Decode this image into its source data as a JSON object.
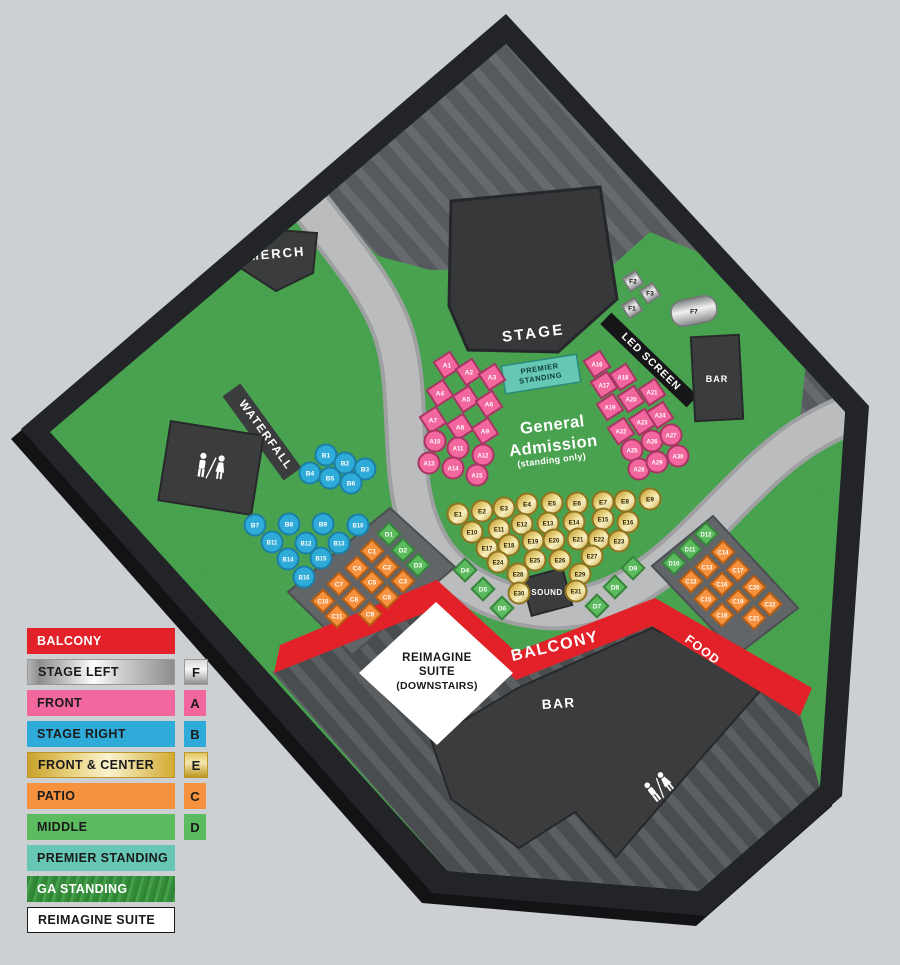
{
  "legend": {
    "items": [
      {
        "label": "BALCONY",
        "badge": "",
        "style": "solid",
        "color": "#E32128",
        "text_color": "#ffffff"
      },
      {
        "label": "STAGE LEFT",
        "badge": "F",
        "style": "silver",
        "color": "",
        "text_color": "#1a1a1a"
      },
      {
        "label": "FRONT",
        "badge": "A",
        "style": "solid",
        "color": "#F2679E",
        "text_color": "#1a1a1a"
      },
      {
        "label": "STAGE RIGHT",
        "badge": "B",
        "style": "solid",
        "color": "#2FABD9",
        "text_color": "#1a1a1a"
      },
      {
        "label": "FRONT & CENTER",
        "badge": "E",
        "style": "gold",
        "color": "",
        "text_color": "#1a1a1a"
      },
      {
        "label": "PATIO",
        "badge": "C",
        "style": "solid",
        "color": "#F6913E",
        "text_color": "#1a1a1a"
      },
      {
        "label": "MIDDLE",
        "badge": "D",
        "style": "solid",
        "color": "#5CBB5E",
        "text_color": "#1a1a1a"
      },
      {
        "label": "PREMIER STANDING",
        "badge": "",
        "style": "solid",
        "color": "#66C7B4",
        "text_color": "#1a1a1a"
      },
      {
        "label": "GA STANDING",
        "badge": "",
        "style": "grass",
        "color": "",
        "text_color": "#ffffff"
      },
      {
        "label": "REIMAGINE SUITE",
        "badge": "",
        "style": "white",
        "color": "#ffffff",
        "text_color": "#1a1a1a"
      }
    ]
  },
  "map": {
    "labels": {
      "merch": "MERCH",
      "waterfall": "WATERFALL",
      "stage": "STAGE",
      "led": "LED SCREEN",
      "bar_top": "BAR",
      "bar_bottom": "BAR",
      "sound": "SOUND",
      "balcony": "BALCONY",
      "food": "FOOD",
      "premier": [
        "PREMIER",
        "STANDING"
      ],
      "ga": [
        "General",
        "Admission",
        "(standing only)"
      ],
      "reimagine": [
        "REIMAGINE",
        "SUITE",
        "(DOWNSTAIRS)"
      ]
    },
    "sections": {
      "A": {
        "name": "FRONT",
        "fill": "#F2679E",
        "stroke": "#A83563",
        "text": "#ffffff"
      },
      "B": {
        "name": "STAGE RIGHT",
        "fill": "#2FABD9",
        "stroke": "#1B7FA6",
        "text": "#ffffff"
      },
      "C": {
        "name": "PATIO",
        "fill": "#F6913E",
        "stroke": "#B65E14",
        "text": "#ffffff"
      },
      "D": {
        "name": "MIDDLE",
        "fill": "#5CBB5E",
        "stroke": "#37853B",
        "text": "#ffffff"
      },
      "E": {
        "name": "FRONT & CENTER",
        "fill": "gold",
        "stroke": "#8F7420",
        "text": "#2e2605"
      },
      "F": {
        "name": "STAGE LEFT",
        "fill": "silver",
        "stroke": "#767676",
        "text": "#141414"
      }
    },
    "tables": {
      "A": [
        [
          "A1",
          447,
          365,
          "q"
        ],
        [
          "A2",
          469,
          372,
          "q"
        ],
        [
          "A3",
          492,
          377,
          "q"
        ],
        [
          "A4",
          440,
          393,
          "q"
        ],
        [
          "A5",
          466,
          399,
          "q"
        ],
        [
          "A6",
          489,
          404,
          "q"
        ],
        [
          "A7",
          433,
          420,
          "q"
        ],
        [
          "A8",
          460,
          427,
          "q"
        ],
        [
          "A9",
          485,
          431,
          "q"
        ],
        [
          "A10",
          435,
          441,
          "c"
        ],
        [
          "A11",
          458,
          448,
          "c"
        ],
        [
          "A12",
          483,
          455,
          "c"
        ],
        [
          "A13",
          429,
          463,
          "c"
        ],
        [
          "A14",
          453,
          468,
          "c"
        ],
        [
          "A15",
          477,
          475,
          "c"
        ],
        [
          "A16",
          597,
          364,
          "q"
        ],
        [
          "A17",
          604,
          385,
          "q"
        ],
        [
          "A18",
          623,
          377,
          "q"
        ],
        [
          "A19",
          610,
          407,
          "q"
        ],
        [
          "A20",
          631,
          399,
          "q"
        ],
        [
          "A21",
          652,
          392,
          "q"
        ],
        [
          "A22",
          621,
          431,
          "q"
        ],
        [
          "A23",
          642,
          422,
          "q"
        ],
        [
          "A24",
          660,
          415,
          "q"
        ],
        [
          "A25",
          632,
          450,
          "c"
        ],
        [
          "A26",
          652,
          441,
          "c"
        ],
        [
          "A27",
          671,
          435,
          "c"
        ],
        [
          "A28",
          639,
          469,
          "c"
        ],
        [
          "A29",
          657,
          462,
          "c"
        ],
        [
          "A30",
          678,
          456,
          "c"
        ]
      ],
      "B": [
        [
          "B1",
          326,
          455,
          "c"
        ],
        [
          "B2",
          345,
          463,
          "c"
        ],
        [
          "B3",
          365,
          469,
          "c"
        ],
        [
          "B4",
          310,
          473,
          "c"
        ],
        [
          "B5",
          330,
          478,
          "c"
        ],
        [
          "B6",
          351,
          483,
          "c"
        ],
        [
          "B7",
          255,
          525,
          "c"
        ],
        [
          "B8",
          289,
          524,
          "c"
        ],
        [
          "B9",
          323,
          524,
          "c"
        ],
        [
          "B10",
          358,
          525,
          "c"
        ],
        [
          "B11",
          272,
          542,
          "c"
        ],
        [
          "B12",
          306,
          543,
          "c"
        ],
        [
          "B13",
          339,
          543,
          "c"
        ],
        [
          "B14",
          288,
          559,
          "c"
        ],
        [
          "B15",
          321,
          558,
          "c"
        ],
        [
          "B16",
          304,
          577,
          "c"
        ]
      ],
      "C": [
        [
          "C1",
          372,
          551,
          "d"
        ],
        [
          "C2",
          387,
          567,
          "d"
        ],
        [
          "C3",
          403,
          581,
          "d"
        ],
        [
          "C4",
          357,
          568,
          "d"
        ],
        [
          "C5",
          372,
          582,
          "d"
        ],
        [
          "C6",
          387,
          597,
          "d"
        ],
        [
          "C7",
          339,
          584,
          "d"
        ],
        [
          "C8",
          354,
          599,
          "d"
        ],
        [
          "C9",
          370,
          614,
          "d"
        ],
        [
          "C10",
          323,
          601,
          "d"
        ],
        [
          "C11",
          337,
          616,
          "d"
        ],
        [
          "C12",
          691,
          581,
          "d"
        ],
        [
          "C13",
          707,
          567,
          "d"
        ],
        [
          "C14",
          723,
          552,
          "d"
        ],
        [
          "C15",
          706,
          599,
          "d"
        ],
        [
          "C16",
          722,
          584,
          "d"
        ],
        [
          "C17",
          738,
          570,
          "d"
        ],
        [
          "C18",
          722,
          615,
          "d"
        ],
        [
          "C19",
          738,
          601,
          "d"
        ],
        [
          "C20",
          754,
          587,
          "d"
        ],
        [
          "C21",
          754,
          618,
          "d"
        ],
        [
          "C22",
          770,
          604,
          "d"
        ]
      ],
      "D": [
        [
          "D1",
          389,
          534,
          "d"
        ],
        [
          "D2",
          403,
          550,
          "d"
        ],
        [
          "D3",
          418,
          565,
          "d"
        ],
        [
          "D4",
          465,
          570,
          "d"
        ],
        [
          "D5",
          483,
          589,
          "d"
        ],
        [
          "D6",
          502,
          608,
          "d"
        ],
        [
          "D7",
          597,
          606,
          "d"
        ],
        [
          "D8",
          615,
          587,
          "d"
        ],
        [
          "D9",
          633,
          568,
          "d"
        ],
        [
          "D10",
          674,
          563,
          "d"
        ],
        [
          "D11",
          690,
          549,
          "d"
        ],
        [
          "D12",
          706,
          534,
          "d"
        ]
      ],
      "E": [
        [
          "E1",
          458,
          514,
          "c"
        ],
        [
          "E2",
          482,
          511,
          "c"
        ],
        [
          "E3",
          504,
          508,
          "c"
        ],
        [
          "E4",
          527,
          504,
          "c"
        ],
        [
          "E5",
          552,
          503,
          "c"
        ],
        [
          "E6",
          577,
          503,
          "c"
        ],
        [
          "E7",
          603,
          502,
          "c"
        ],
        [
          "E8",
          625,
          501,
          "c"
        ],
        [
          "E9",
          650,
          499,
          "c"
        ],
        [
          "E10",
          472,
          532,
          "c"
        ],
        [
          "E11",
          499,
          529,
          "c"
        ],
        [
          "E12",
          522,
          524,
          "c"
        ],
        [
          "E13",
          548,
          523,
          "c"
        ],
        [
          "E14",
          574,
          522,
          "c"
        ],
        [
          "E15",
          603,
          519,
          "c"
        ],
        [
          "E16",
          628,
          522,
          "c"
        ],
        [
          "E17",
          487,
          548,
          "c"
        ],
        [
          "E18",
          509,
          545,
          "c"
        ],
        [
          "E19",
          533,
          541,
          "c"
        ],
        [
          "E20",
          554,
          540,
          "c"
        ],
        [
          "E21",
          578,
          539,
          "c"
        ],
        [
          "E22",
          599,
          539,
          "c"
        ],
        [
          "E23",
          619,
          541,
          "c"
        ],
        [
          "E24",
          498,
          562,
          "c"
        ],
        [
          "E25",
          535,
          560,
          "c"
        ],
        [
          "E26",
          560,
          560,
          "c"
        ],
        [
          "E27",
          592,
          556,
          "c"
        ],
        [
          "E28",
          518,
          574,
          "c"
        ],
        [
          "E29",
          580,
          574,
          "c"
        ],
        [
          "E30",
          519,
          593,
          "c"
        ],
        [
          "E31",
          576,
          591,
          "c"
        ]
      ],
      "F": [
        [
          "F1",
          632,
          308,
          "f"
        ],
        [
          "F2",
          633,
          281,
          "f"
        ],
        [
          "F3",
          650,
          293,
          "f"
        ],
        [
          "F7",
          694,
          311,
          "y"
        ]
      ]
    },
    "colors": {
      "background": "#CDD0D2",
      "border": "#232427",
      "border_shadow": "#131316",
      "grass": "#3F9A44",
      "hatch_top": "#56595D",
      "hatch_top_stripe": "#66696D",
      "hatch_bottom": "#4A4D50",
      "hatch_bottom_stripe": "#5B5F62",
      "walkway": "#BABCBE",
      "walkway_edge": "#9EA0A2",
      "structure": "#3B3C3E",
      "structure_edge": "#27282A",
      "balcony_red": "#E32128",
      "suite_white": "#FFFFFF",
      "patio_gray": "#626568"
    }
  }
}
